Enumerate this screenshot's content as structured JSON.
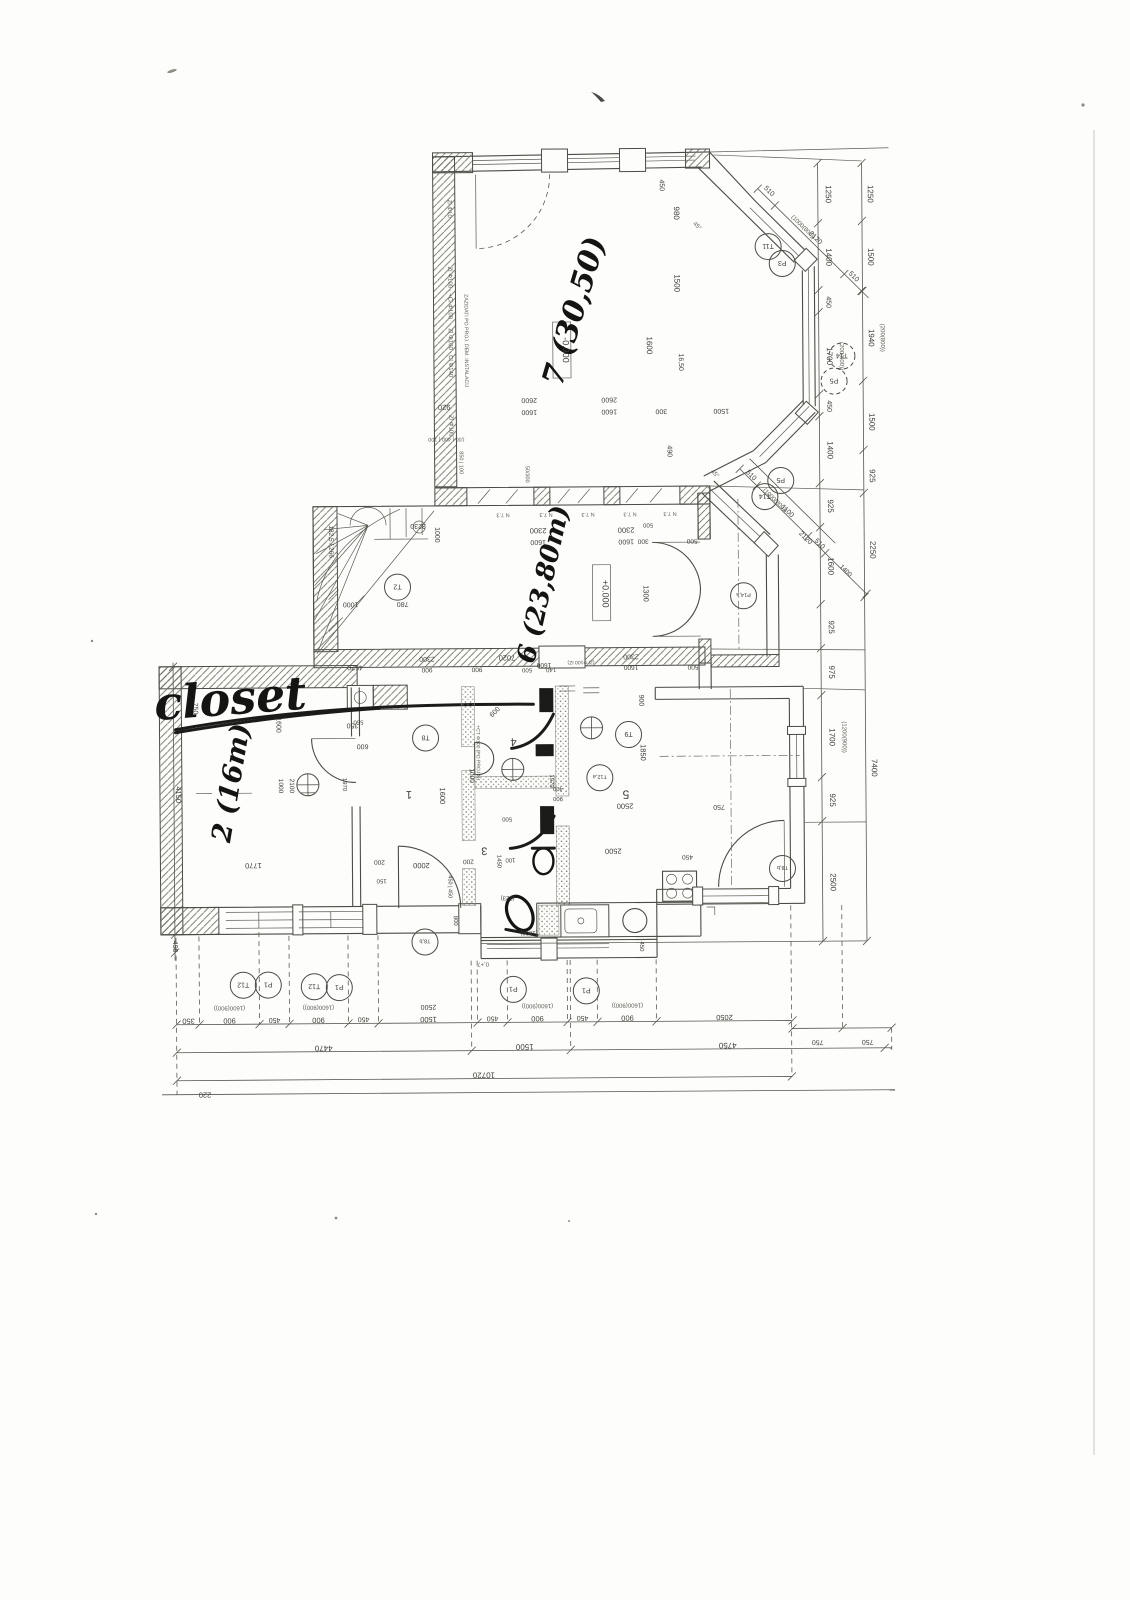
{
  "drawing": {
    "kind": "scanned floor plan",
    "level_markers": {
      "ground": "+0.000",
      "lower": "-0.300"
    },
    "handwritten": {
      "closet": "closet",
      "room2": "2 (16m)",
      "room7": "7 (30,50)",
      "room6": "6 (23,80m)"
    },
    "room_numbers": [
      "1",
      "3",
      "4",
      "5"
    ],
    "overall_dims": {
      "bottom_total": "10720",
      "bottom_row2": [
        "4470",
        "1500",
        "4750"
      ],
      "left_note": "220"
    }
  },
  "labels": [
    [
      "closet",
      232,
      712,
      -4,
      46,
      "h"
    ],
    [
      "2 (16m)",
      240,
      782,
      -80,
      27,
      "h"
    ],
    [
      "7 (30,50)",
      587,
      314,
      -73,
      30,
      "h"
    ],
    [
      "6 (23,80m)",
      553,
      586,
      -77,
      26,
      "h"
    ],
    [
      "-0.300",
      566,
      350,
      90,
      9,
      "d"
    ],
    [
      "+0.000",
      604,
      594,
      90,
      9,
      "d"
    ],
    [
      "1",
      409,
      790,
      180,
      11,
      "n"
    ],
    [
      "3",
      484,
      847,
      180,
      11,
      "n"
    ],
    [
      "4",
      514,
      738,
      180,
      11,
      "n"
    ],
    [
      "5",
      626,
      791,
      180,
      12,
      "n"
    ],
    [
      "1250",
      830,
      196,
      90,
      8,
      "d"
    ],
    [
      "1400",
      830,
      259,
      90,
      8,
      "d"
    ],
    [
      "450",
      830,
      304,
      90,
      7,
      "d"
    ],
    [
      "1700",
      830,
      358,
      90,
      8,
      "d"
    ],
    [
      "(200(800))",
      843,
      358,
      90,
      6,
      "t"
    ],
    [
      "450",
      830,
      408,
      90,
      7,
      "d"
    ],
    [
      "1400",
      830,
      452,
      90,
      8,
      "d"
    ],
    [
      "925",
      830,
      508,
      90,
      8,
      "d"
    ],
    [
      "1600",
      830,
      568,
      90,
      8,
      "d"
    ],
    [
      "925",
      830,
      629,
      90,
      8,
      "d"
    ],
    [
      "975",
      830,
      674,
      90,
      8,
      "d"
    ],
    [
      "1700",
      830,
      739,
      90,
      8,
      "d"
    ],
    [
      "(1200(900))",
      843,
      739,
      90,
      6,
      "t"
    ],
    [
      "925",
      830,
      802,
      90,
      8,
      "d"
    ],
    [
      "2500",
      830,
      884,
      90,
      8,
      "d"
    ],
    [
      "1250",
      872,
      196,
      90,
      8,
      "d"
    ],
    [
      "1500",
      872,
      259,
      90,
      8,
      "d"
    ],
    [
      "1940",
      872,
      340,
      90,
      8,
      "d"
    ],
    [
      "(200(800))",
      884,
      340,
      90,
      6,
      "t"
    ],
    [
      "1500",
      872,
      424,
      90,
      8,
      "d"
    ],
    [
      "925",
      872,
      478,
      90,
      8,
      "d"
    ],
    [
      "2250",
      872,
      552,
      90,
      8,
      "d"
    ],
    [
      "7400",
      872,
      770,
      90,
      8,
      "d"
    ],
    [
      "350",
      187,
      1016,
      180,
      7.5,
      "d"
    ],
    [
      "900",
      228,
      1016,
      180,
      7.5,
      "d"
    ],
    [
      "(1600(900))",
      228,
      1004,
      180,
      6,
      "t"
    ],
    [
      "450",
      273,
      1016,
      180,
      7,
      "d"
    ],
    [
      "900",
      317,
      1016,
      180,
      7.5,
      "d"
    ],
    [
      "(1600(900))",
      317,
      1004,
      180,
      6,
      "t"
    ],
    [
      "450",
      362,
      1016,
      180,
      7,
      "d"
    ],
    [
      "1500",
      427,
      1016,
      180,
      7.5,
      "d"
    ],
    [
      "2500",
      427,
      1004,
      180,
      7,
      "d"
    ],
    [
      "450",
      491,
      1016,
      180,
      7,
      "d"
    ],
    [
      "900",
      536,
      1016,
      180,
      7.5,
      "d"
    ],
    [
      "(1600(900))",
      536,
      1004,
      180,
      6,
      "t"
    ],
    [
      "450",
      581,
      1016,
      180,
      7,
      "d"
    ],
    [
      "900",
      626,
      1016,
      180,
      7.5,
      "d"
    ],
    [
      "(1600(900))",
      626,
      1004,
      180,
      6,
      "t"
    ],
    [
      "2050",
      723,
      1016,
      180,
      7.5,
      "d"
    ],
    [
      "750",
      816,
      1042,
      180,
      7,
      "d"
    ],
    [
      "750",
      866,
      1042,
      180,
      7,
      "d"
    ],
    [
      "4470",
      322,
      1044,
      180,
      8,
      "d"
    ],
    [
      "1500",
      523,
      1044,
      180,
      8,
      "d"
    ],
    [
      "4750",
      726,
      1044,
      180,
      8,
      "d"
    ],
    [
      "10720",
      482,
      1072,
      180,
      8,
      "d"
    ],
    [
      "220",
      203,
      1090,
      180,
      7.5,
      "d"
    ],
    [
      "510",
      772,
      194,
      45,
      7,
      "d"
    ],
    [
      "2120",
      818,
      241,
      45,
      7,
      "d"
    ],
    [
      "(1000(800))",
      806,
      230,
      45,
      6,
      "t"
    ],
    [
      "510",
      856,
      280,
      45,
      7,
      "d"
    ],
    [
      "45°",
      700,
      228,
      45,
      6,
      "t"
    ],
    [
      "510",
      752,
      478,
      45,
      7,
      "d"
    ],
    [
      "1100",
      788,
      514,
      45,
      7,
      "d"
    ],
    [
      "(1000(800))",
      776,
      503,
      45,
      6,
      "t"
    ],
    [
      "510",
      820,
      547,
      45,
      7,
      "d"
    ],
    [
      "2120",
      806,
      541,
      45,
      7,
      "d"
    ],
    [
      "1400",
      846,
      574,
      45,
      6.5,
      "d"
    ],
    [
      "45°",
      716,
      476,
      45,
      6,
      "t"
    ],
    [
      "450",
      664,
      186,
      90,
      7,
      "d"
    ],
    [
      "980",
      678,
      214,
      90,
      8,
      "d"
    ],
    [
      "1500",
      678,
      284,
      90,
      8,
      "d"
    ],
    [
      "1600",
      650,
      346,
      90,
      8,
      "d"
    ],
    [
      "16,50",
      682,
      363,
      90,
      7,
      "d"
    ],
    [
      "490",
      670,
      452,
      90,
      7,
      "d"
    ],
    [
      "920",
      447,
      404,
      180,
      7.5,
      "d"
    ],
    [
      "2600",
      532,
      398,
      180,
      7,
      "d"
    ],
    [
      "1600",
      532,
      410,
      180,
      7,
      "d"
    ],
    [
      "2600",
      612,
      398,
      180,
      7,
      "d"
    ],
    [
      "1600",
      612,
      410,
      180,
      7,
      "d"
    ],
    [
      "300",
      664,
      410,
      180,
      7,
      "d"
    ],
    [
      "1500",
      724,
      410,
      180,
      7,
      "d"
    ],
    [
      "Zl Φ10",
      452,
      208,
      90,
      6,
      "t"
    ],
    [
      "Zl Φ100 · +Cl Φ100",
      452,
      292,
      90,
      6,
      "t"
    ],
    [
      "Zl Φ100 · Cl Φ140",
      452,
      352,
      90,
      6,
      "t"
    ],
    [
      "ZAZIDATI PO PROJ. DEM. INSTALACIJ",
      468,
      340,
      90,
      5.2,
      "t"
    ],
    [
      "Zl Φ100",
      452,
      425,
      90,
      6,
      "t"
    ],
    [
      "100 | 400 | 100",
      449,
      437,
      180,
      5.5,
      "t"
    ],
    [
      "850 | 100",
      462,
      462,
      90,
      5.5,
      "t"
    ],
    [
      "50/300",
      528,
      474,
      90,
      5.5,
      "t"
    ],
    [
      "N 7.3",
      505,
      513,
      180,
      5.5,
      "t"
    ],
    [
      "N 7.3",
      548,
      513,
      180,
      5.5,
      "t"
    ],
    [
      "N 7.3",
      590,
      513,
      180,
      5.5,
      "t"
    ],
    [
      "N 7.3",
      632,
      513,
      180,
      5.5,
      "t"
    ],
    [
      "N 7.3",
      672,
      513,
      180,
      5.5,
      "t"
    ],
    [
      "500",
      650,
      524,
      180,
      6,
      "d"
    ],
    [
      "2300",
      540,
      528,
      180,
      7.5,
      "d"
    ],
    [
      "1600",
      540,
      540,
      180,
      7,
      "d"
    ],
    [
      "300",
      645,
      540,
      180,
      6.5,
      "d"
    ],
    [
      "2300",
      628,
      528,
      180,
      7.5,
      "d"
    ],
    [
      "1600",
      628,
      540,
      180,
      7,
      "d"
    ],
    [
      "500",
      694,
      540,
      180,
      6.5,
      "d"
    ],
    [
      "3230",
      420,
      523,
      180,
      7,
      "d"
    ],
    [
      "1000",
      437,
      534,
      90,
      7,
      "d"
    ],
    [
      "182,5 / 266",
      331,
      540,
      90,
      6.5,
      "d"
    ],
    [
      "780",
      404,
      601,
      180,
      7,
      "d"
    ],
    [
      "1000",
      352,
      601,
      180,
      7,
      "d"
    ],
    [
      "7020",
      508,
      655,
      180,
      7.5,
      "d"
    ],
    [
      "1300",
      645,
      594,
      90,
      7.5,
      "d"
    ],
    [
      "4520",
      356,
      664,
      180,
      7,
      "d"
    ],
    [
      "2300",
      428,
      656,
      180,
      7,
      "d"
    ],
    [
      "900",
      428,
      667,
      180,
      6.5,
      "d"
    ],
    [
      "900",
      478,
      667,
      180,
      6.5,
      "d"
    ],
    [
      "1600",
      545,
      663,
      180,
      6.5,
      "d"
    ],
    [
      "500",
      528,
      668,
      180,
      6,
      "d"
    ],
    [
      "140",
      552,
      668,
      180,
      6,
      "d"
    ],
    [
      "(Zl Φ100 IZ)",
      582,
      661,
      180,
      5,
      "t"
    ],
    [
      "2300",
      632,
      655,
      180,
      7,
      "d"
    ],
    [
      "1600",
      632,
      666,
      180,
      6.5,
      "d"
    ],
    [
      "500",
      694,
      666,
      180,
      6.5,
      "d"
    ],
    [
      "750",
      194,
      706,
      90,
      7,
      "d"
    ],
    [
      "1600",
      277,
      723,
      90,
      7,
      "d"
    ],
    [
      "350",
      353,
      722,
      180,
      7,
      "d"
    ],
    [
      "600",
      363,
      743,
      180,
      7,
      "d"
    ],
    [
      "4150",
      176,
      792,
      90,
      7.5,
      "d"
    ],
    [
      "450",
      172,
      944,
      90,
      7,
      "d"
    ],
    [
      "1770",
      253,
      861,
      180,
      7.5,
      "d"
    ],
    [
      "1000",
      279,
      784,
      90,
      6.5,
      "d"
    ],
    [
      "2100",
      290,
      784,
      90,
      6.5,
      "d"
    ],
    [
      "1970",
      343,
      783,
      90,
      6,
      "d"
    ],
    [
      "550",
      359,
      719,
      180,
      6,
      "d"
    ],
    [
      "1600",
      440,
      795,
      90,
      7.5,
      "d"
    ],
    [
      "2000",
      421,
      862,
      180,
      7.5,
      "d"
    ],
    [
      "200",
      379,
      859,
      180,
      6.5,
      "d"
    ],
    [
      "200",
      468,
      859,
      180,
      6.5,
      "d"
    ],
    [
      "150",
      381,
      878,
      180,
      6,
      "d"
    ],
    [
      "450 | 450",
      448,
      886,
      90,
      5.5,
      "d"
    ],
    [
      "0,+7",
      482,
      962,
      180,
      6,
      "t"
    ],
    [
      "600",
      497,
      713,
      -45,
      7,
      "d"
    ],
    [
      "+CT Φ100 (PO PROJ.N)",
      477,
      752,
      90,
      5,
      "t"
    ],
    [
      "1000",
      470,
      775,
      90,
      6.5,
      "d"
    ],
    [
      "500",
      507,
      817,
      180,
      6,
      "d"
    ],
    [
      "1970",
      550,
      781,
      90,
      6,
      "d"
    ],
    [
      "400",
      558,
      787,
      180,
      6,
      "d"
    ],
    [
      "900",
      558,
      797,
      180,
      6,
      "d"
    ],
    [
      "1450",
      497,
      861,
      90,
      6,
      "d"
    ],
    [
      "100",
      510,
      858,
      180,
      6,
      "d"
    ],
    [
      "800",
      453,
      920,
      90,
      6,
      "d"
    ],
    [
      "(1800)",
      528,
      931,
      180,
      6,
      "d"
    ],
    [
      "(223)",
      507,
      896,
      180,
      6,
      "d"
    ],
    [
      "900",
      640,
      701,
      90,
      7,
      "d"
    ],
    [
      "1850",
      641,
      753,
      90,
      7.5,
      "d"
    ],
    [
      "2500",
      625,
      804,
      180,
      7.5,
      "d"
    ],
    [
      "750",
      719,
      806,
      180,
      7,
      "d"
    ],
    [
      "2500",
      613,
      849,
      180,
      7.5,
      "d"
    ],
    [
      "450",
      687,
      856,
      180,
      6.5,
      "d"
    ],
    [
      "450",
      639,
      947,
      90,
      6,
      "d"
    ]
  ],
  "circle_labels": [
    [
      "T12",
      242,
      983,
      0
    ],
    [
      "P1",
      267,
      983,
      0
    ],
    [
      "T12",
      313,
      985,
      0
    ],
    [
      "P1",
      338,
      986,
      0
    ],
    [
      "P1",
      512,
      989,
      0
    ],
    [
      "P1",
      585,
      991,
      0
    ],
    [
      "T8,b",
      424,
      941,
      0
    ],
    [
      "T8,b",
      782,
      870,
      0
    ],
    [
      "P14,a",
      745,
      597,
      0
    ],
    [
      "T11",
      772,
      248,
      0
    ],
    [
      "P3",
      786,
      265,
      0
    ],
    [
      "T14",
      845,
      358,
      1
    ],
    [
      "P5",
      837,
      383,
      1
    ],
    [
      "T14",
      767,
      498,
      0
    ],
    [
      "P5",
      783,
      482,
      0
    ],
    [
      "T2",
      399,
      586,
      0
    ],
    [
      "T8",
      426,
      737,
      0
    ],
    [
      "T9",
      629,
      735,
      0
    ],
    [
      "T12,a",
      600,
      778,
      0
    ]
  ],
  "cross_fixtures": [
    [
      308,
      783
    ],
    [
      592,
      728
    ],
    [
      513,
      769
    ]
  ]
}
